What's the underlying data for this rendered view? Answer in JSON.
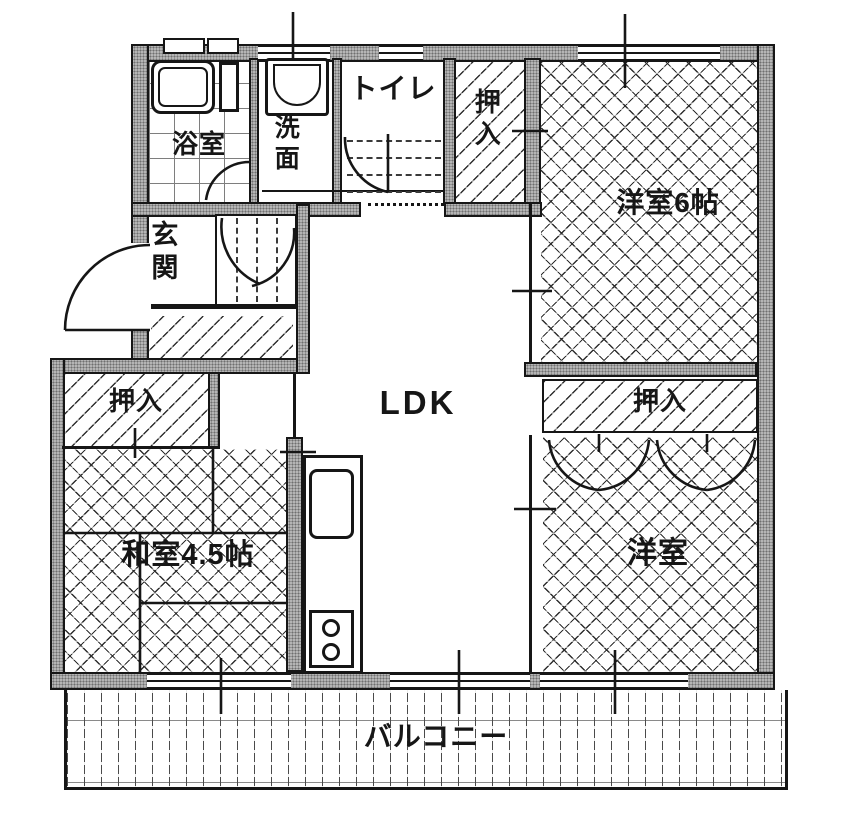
{
  "colors": {
    "paper": "#ffffff",
    "wall_fill": "#b5b5b5",
    "wall_dot": "#6f6f6f",
    "line": "#161616"
  },
  "rooms": {
    "bath": {
      "label": "浴室"
    },
    "washroom": {
      "label": "洗面"
    },
    "toilet": {
      "label": "トイレ"
    },
    "closet_top": {
      "label": "押入"
    },
    "western_room_6": {
      "label": "洋室6帖"
    },
    "entrance": {
      "label": "玄関"
    },
    "ldk": {
      "label": "LDK"
    },
    "closet_left": {
      "label": "押入"
    },
    "japanese_room": {
      "label": "和室4.5帖"
    },
    "closet_right": {
      "label": "押入"
    },
    "western_room_2": {
      "label": "洋室"
    },
    "balcony": {
      "label": "バルコニー"
    }
  }
}
